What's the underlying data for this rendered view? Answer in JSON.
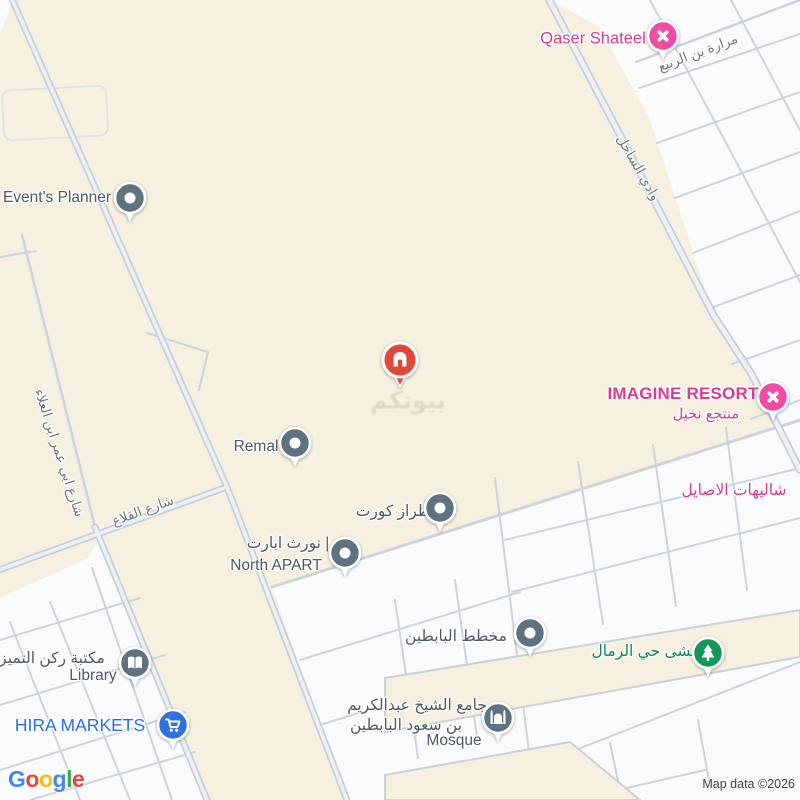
{
  "colors": {
    "land_beige": "#f6f0e0",
    "block_white": "#fafbfc",
    "road_line": "#ccd4dd",
    "road_casing": "#c6cfd9",
    "road_fill": "#edf0f4",
    "poi_gray_pin": "#5e7280",
    "poi_pink_pin": "#ee4da3",
    "poi_blue_pin": "#2e72dd",
    "poi_green_pin": "#12975c",
    "poi_red_pin": "#e3473a",
    "label_gray": "#4e5a64",
    "label_pink": "#d63d92",
    "label_blue": "#2a6fdb",
    "label_green": "#0d8a52"
  },
  "places": {
    "qaser": {
      "label": "Qaser Shateel"
    },
    "events": {
      "label": "Event's Planner"
    },
    "imagine": {
      "label": "IMAGINE RESORT",
      "sublabel": "منتجع نخيل"
    },
    "shalihat": {
      "label": "شاليهات الاصايل"
    },
    "remal": {
      "label": "Remal"
    },
    "tiraz": {
      "label": "طراز كورت"
    },
    "north_apart": {
      "label_ar": "نورث ابارت |",
      "label_en": "North APART"
    },
    "mokhatat": {
      "label": "مخطط البابطين"
    },
    "mamsha": {
      "label": "ممشى حي الرمال"
    },
    "library": {
      "label_ar": "مكتبة ركن التميز",
      "label_en": "Library"
    },
    "hira": {
      "label": "HIRA MARKETS"
    },
    "mosque": {
      "label_ar_1": "جامع الشيخ عبدالكريم",
      "label_ar_2": "بن سعود البابطين",
      "label_en": "Mosque"
    }
  },
  "roads": {
    "rabee": "مرارة بن الربيع",
    "sahel": "وادي الساحل",
    "qalaa": "شارع القلاع",
    "omar": "شارع ابي عمر ابن العلاء"
  },
  "watermark": {
    "text": "بيوتكم"
  },
  "attribution": {
    "map_data": "Map data ©2026",
    "logo_letters": [
      {
        "ch": "G",
        "color": "#4285F4"
      },
      {
        "ch": "o",
        "color": "#EA4335"
      },
      {
        "ch": "o",
        "color": "#FBBC05"
      },
      {
        "ch": "g",
        "color": "#4285F4"
      },
      {
        "ch": "l",
        "color": "#34A853"
      },
      {
        "ch": "e",
        "color": "#EA4335"
      }
    ]
  }
}
